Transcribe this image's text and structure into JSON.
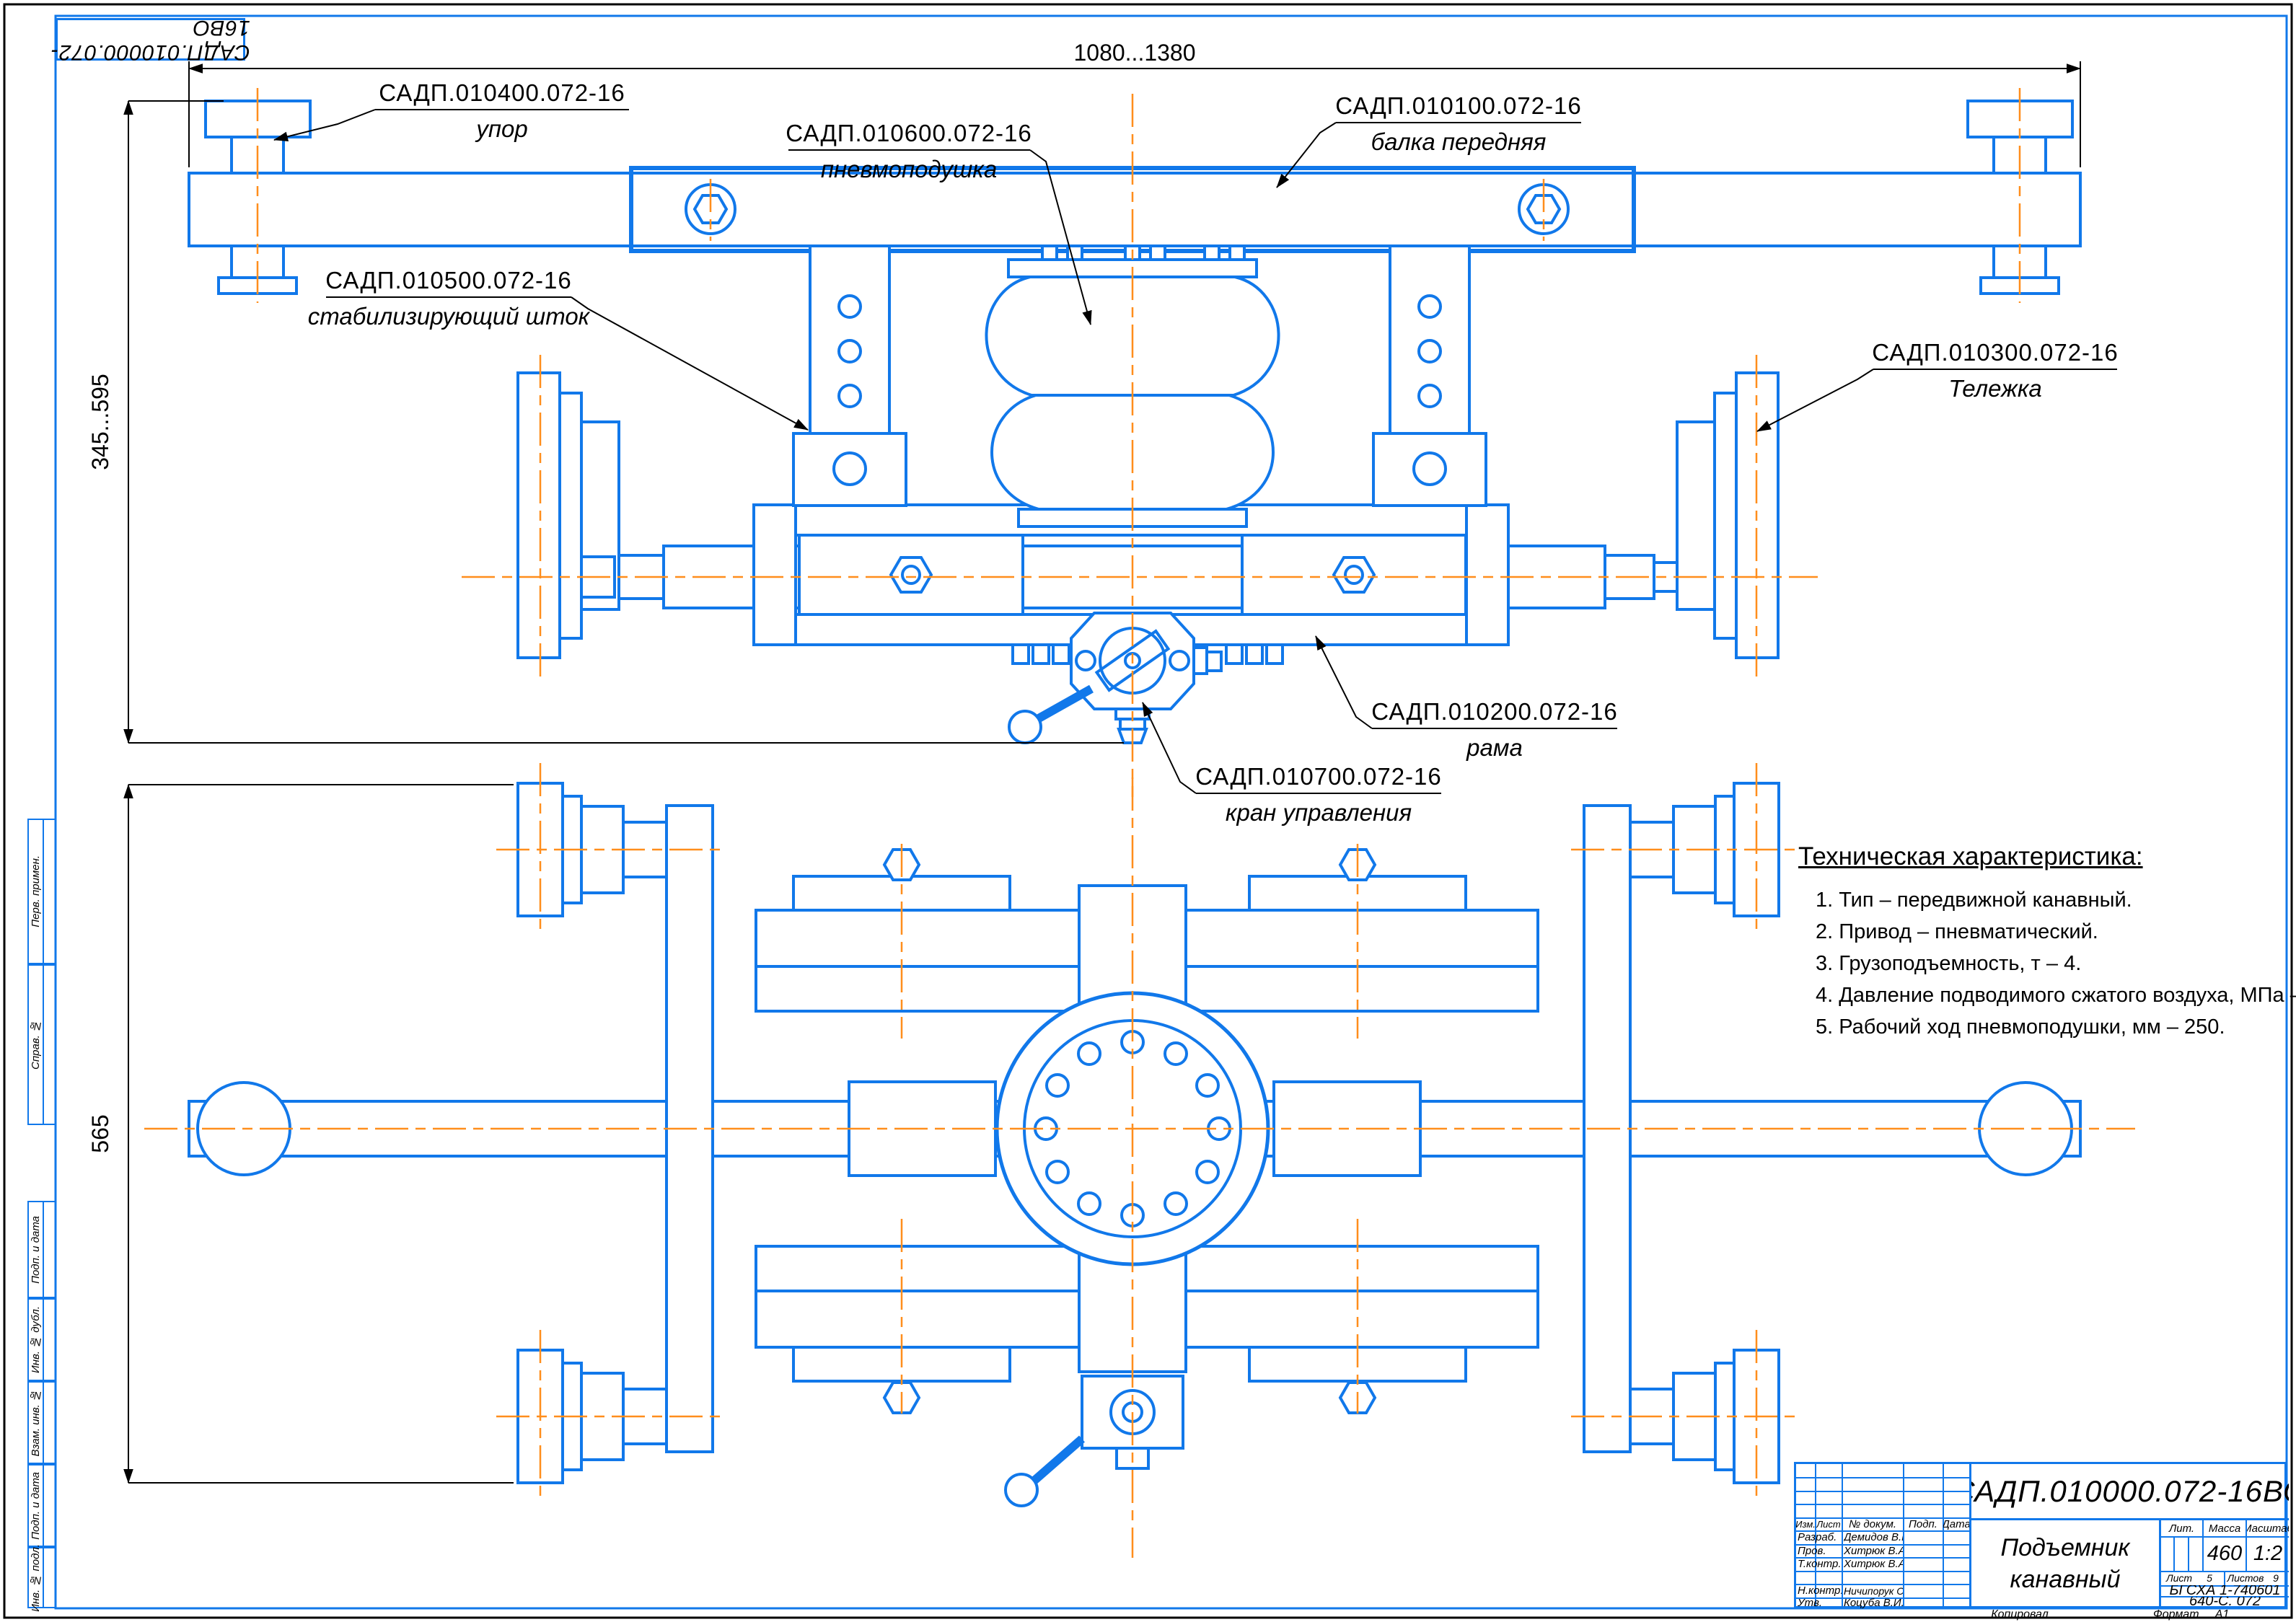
{
  "page": {
    "corner_doc_number": "САДП.010000.072-16ВО",
    "copied_label": "Копировал",
    "format_label": "Формат",
    "format_value": "А1"
  },
  "dimensions": {
    "top": "1080...1380",
    "left_front": "345...595",
    "left_plan": "565"
  },
  "callouts": [
    {
      "code": "САДП.010400.072-16",
      "name": "упор"
    },
    {
      "code": "САДП.010600.072-16",
      "name": "пневмоподушка"
    },
    {
      "code": "САДП.010100.072-16",
      "name": "балка передняя"
    },
    {
      "code": "САДП.010500.072-16",
      "name": "стабилизирующий шток"
    },
    {
      "code": "САДП.010300.072-16",
      "name": "Тележка"
    },
    {
      "code": "САДП.010200.072-16",
      "name": "рама"
    },
    {
      "code": "САДП.010700.072-16",
      "name": "кран управления"
    }
  ],
  "tech_spec": {
    "title": "Техническая характеристика:",
    "items": [
      "1. Тип – передвижной канавный.",
      "2. Привод – пневматический.",
      "3. Грузоподъемность, т – 4.",
      "4. Давление подводимого сжатого воздуха, МПа – 0,5.",
      "5. Рабочий ход пневмоподушки, мм – 250."
    ]
  },
  "title_block": {
    "doc_number": "САДП.010000.072-16ВО",
    "title_line1": "Подъемник",
    "title_line2": "канавный",
    "lit_label": "Лит.",
    "mass_label": "Масса",
    "mass_value": "460",
    "scale_label": "Масштаб",
    "scale_value": "1:2",
    "sheet_label": "Лист",
    "sheet_value": "5",
    "sheets_label": "Листов",
    "sheets_value": "9",
    "org_line1": "БГСХА 1-740601",
    "org_line2": "640-С. 072",
    "header": {
      "izm": "Изм.",
      "list": "Лист",
      "doc": "№ докум.",
      "podp": "Подп.",
      "data": "Дата"
    },
    "rows": [
      {
        "role": "Разраб.",
        "name": "Демидов В.В."
      },
      {
        "role": "Пров.",
        "name": "Хитрюк В.А."
      },
      {
        "role": "Т.контр.",
        "name": "Хитрюк В.А."
      },
      {
        "role": "",
        "name": ""
      },
      {
        "role": "Н.контр.",
        "name": "Ничипорук С.Н."
      },
      {
        "role": "Утв.",
        "name": "Коцуба В.И."
      }
    ]
  },
  "side_stamps": {
    "group1": [
      "Перв. примен.",
      "Справ. №"
    ],
    "group2": [
      "Подп. и дата",
      "Инв. № дубл.",
      "Взам. инв. №",
      "Подп. и дата",
      "Инв. № подл."
    ]
  },
  "colors": {
    "line_blue": "#1178EA",
    "centerline_orange": "#FF8E1C",
    "ink_black": "#000000"
  }
}
